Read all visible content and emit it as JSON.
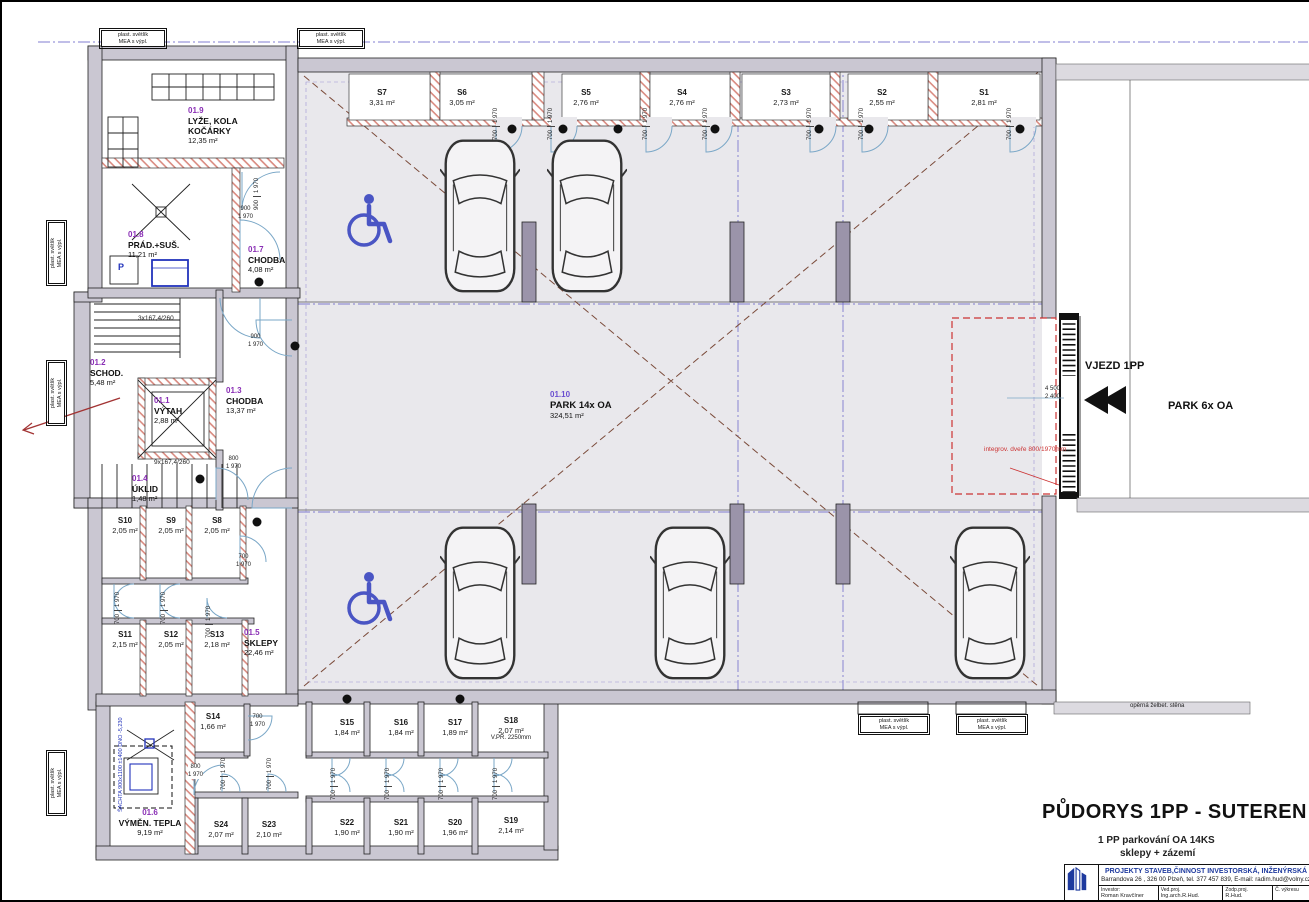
{
  "sheet": {
    "title": "PŮDORYS  1PP - SUTEREN",
    "subtitle1": "1 PP   parkování OA   14KS",
    "subtitle2": "sklepy + zázemí"
  },
  "titleblock": {
    "company": "PROJEKTY STAVEB,ČINNOST INVESTORSKÁ, INŽENÝRSKÁ",
    "address": "Barrandova 26 , 326 00 Plzeň, tel. 377 457 839, E-mail: radim.hud@volny.cz",
    "investor_label": "Investor:",
    "investor": "Roman Kravčíner",
    "ved_label": "Ved.proj.",
    "ved": "Ing.arch.R.Hud.",
    "zodp_label": "Zodp.proj.",
    "zodp": "R.Hud.",
    "cislo_label": "Č. výkresu"
  },
  "rooms": {
    "r1": {
      "id": "01.1",
      "name": "VÝTAH",
      "area": "2,88 m²"
    },
    "r2": {
      "id": "01.2",
      "name": "SCHOD.",
      "area": "5,48 m²"
    },
    "r3": {
      "id": "01.3",
      "name": "CHODBA",
      "area": "13,37 m²"
    },
    "r4": {
      "id": "01.4",
      "name": "ÚKLID",
      "area": "1,48 m²"
    },
    "r5": {
      "id": "01.5",
      "name": "SKLEPY",
      "area": "22,46 m²"
    },
    "r6": {
      "id": "01.6",
      "name": "VÝMĚN. TEPLA",
      "area": "9,19 m²"
    },
    "r7": {
      "id": "01.7",
      "name": "CHODBA",
      "area": "4,08 m²"
    },
    "r8": {
      "id": "01.8",
      "name": "PRÁD.+SUŠ.",
      "area": "11,21 m²"
    },
    "r9": {
      "id": "01.9",
      "name": "LYŽE, KOLA\nKOČÁRKY",
      "area": "12,35 m²"
    },
    "r10": {
      "id": "01.10",
      "name": "PARK 14x OA",
      "area": "324,51 m²"
    }
  },
  "cells": {
    "s1": {
      "id": "S1",
      "area": "2,81 m²"
    },
    "s2": {
      "id": "S2",
      "area": "2,55 m²"
    },
    "s3": {
      "id": "S3",
      "area": "2,73 m²"
    },
    "s4": {
      "id": "S4",
      "area": "2,76 m²"
    },
    "s5": {
      "id": "S5",
      "area": "2,76 m²"
    },
    "s6": {
      "id": "S6",
      "area": "3,05 m²"
    },
    "s7": {
      "id": "S7",
      "area": "3,31 m²"
    },
    "s8": {
      "id": "S8",
      "area": "2,05 m²"
    },
    "s9": {
      "id": "S9",
      "area": "2,05 m²"
    },
    "s10": {
      "id": "S10",
      "area": "2,05 m²"
    },
    "s11": {
      "id": "S11",
      "area": "2,15 m²"
    },
    "s12": {
      "id": "S12",
      "area": "2,05 m²"
    },
    "s13": {
      "id": "S13",
      "area": "2,18 m²"
    },
    "s14": {
      "id": "S14",
      "area": "1,66 m²"
    },
    "s15": {
      "id": "S15",
      "area": "1,84 m²"
    },
    "s16": {
      "id": "S16",
      "area": "1,84 m²"
    },
    "s17": {
      "id": "S17",
      "area": "1,89 m²"
    },
    "s18": {
      "id": "S18",
      "area": "2,07 m²",
      "note": "V.PŘ. 2250mm"
    },
    "s19": {
      "id": "S19",
      "area": "2,14 m²"
    },
    "s20": {
      "id": "S20",
      "area": "1,96 m²"
    },
    "s21": {
      "id": "S21",
      "area": "1,90 m²"
    },
    "s22": {
      "id": "S22",
      "area": "1,90 m²"
    },
    "s23": {
      "id": "S23",
      "area": "2,10 m²"
    },
    "s24": {
      "id": "S24",
      "area": "2,07 m²"
    }
  },
  "annotations": {
    "vjezd": "VJEZD 1PP",
    "park6": "PARK 6x OA",
    "integrov": "integrov. dveře\n800/1970mm",
    "operna": "opěrná želbet. stěna",
    "d4500": "4 500",
    "d2400": "2 400",
    "stair3": "3x167,4/260",
    "stair9": "9x167,4/260",
    "sachta": "ŠACHTA 900x1100\n±1400\nDNO -5,230",
    "svetlik": "plast. světlík\nMEA s výpl.",
    "washer": "P"
  },
  "dims": {
    "d700": "700",
    "d800": "800",
    "d900": "900",
    "d1970": "1 970"
  },
  "colors": {
    "room_id": "#8a2fb5",
    "hatch": "#d98a80",
    "blue_symbol": "#4a55c4",
    "axis_blue": "#6b66c9",
    "red_dash": "#cc3333",
    "company_blue": "#1e3a9e",
    "wall_gray": "#cac7d2",
    "floor_gray": "#e9e8ec"
  },
  "icons": {
    "wheelchair": "wheelchair-icon",
    "car": "car-icon",
    "entry_arrow": "entry-arrow-icon",
    "logo": "building-logo-icon"
  }
}
